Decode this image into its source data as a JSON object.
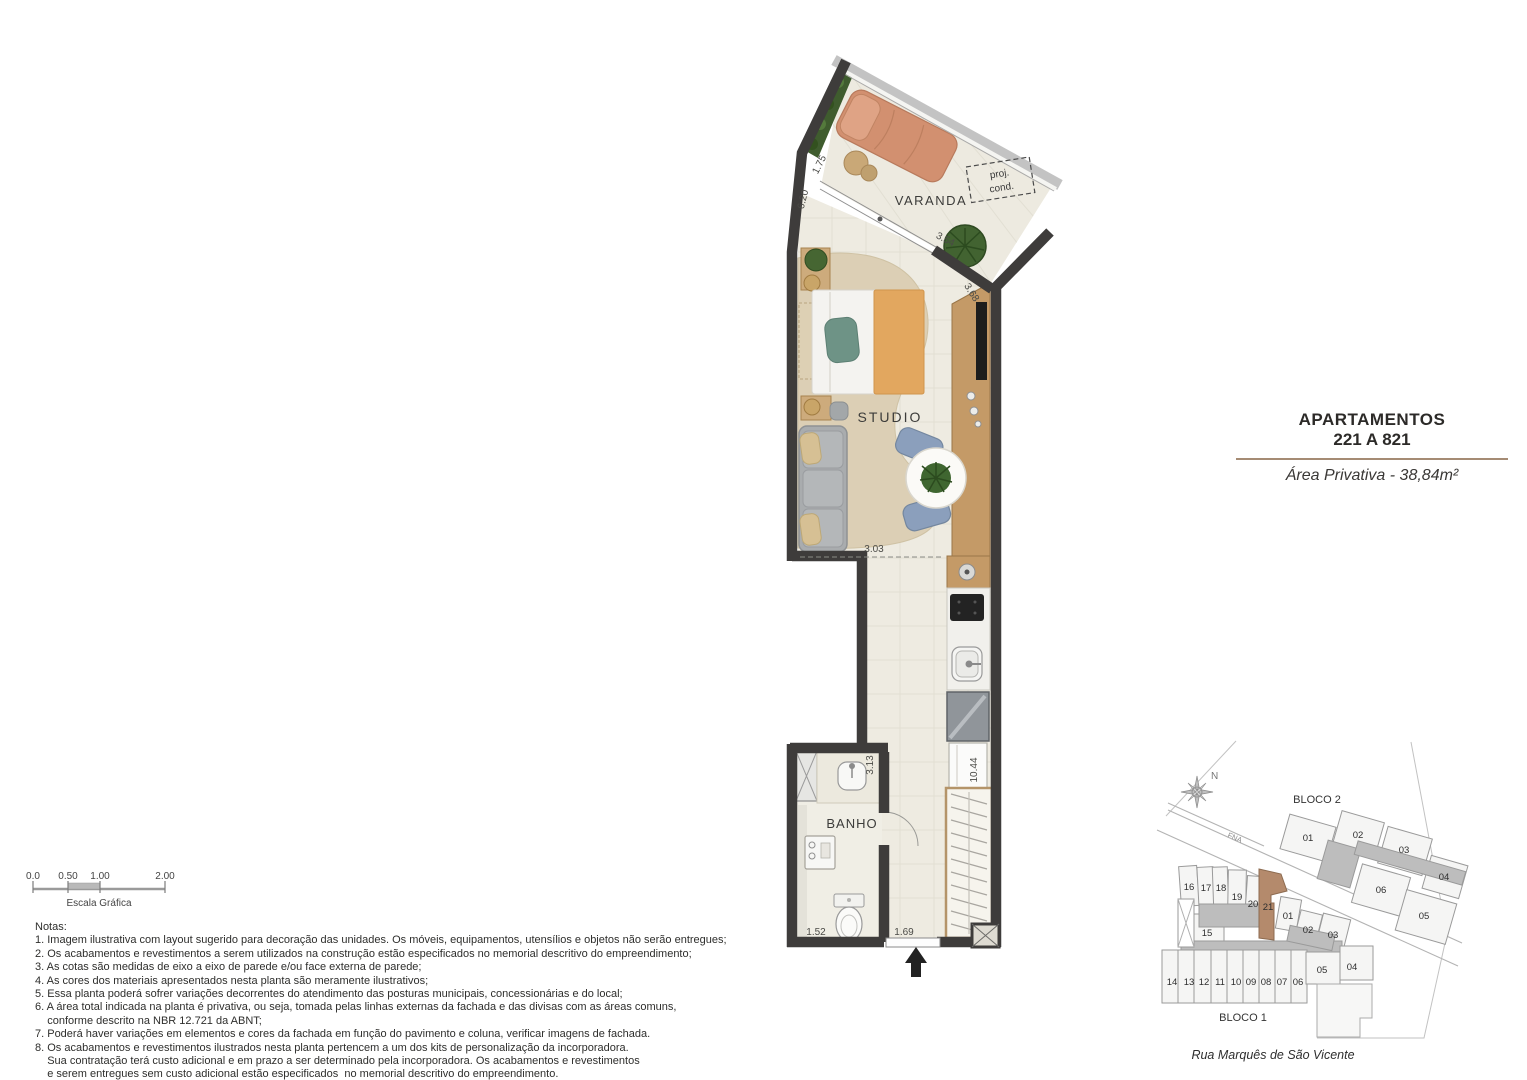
{
  "title_block": {
    "line1": "APARTAMENTOS",
    "line2": "221 A 821",
    "area_label": "Área Privativa - 38,84m²"
  },
  "floor_plan": {
    "room_labels": {
      "varanda": "VARANDA",
      "studio": "STUDIO",
      "banho": "BANHO"
    },
    "proj_cond": {
      "line1": "proj.",
      "line2": "cond."
    },
    "dimensions": {
      "varanda_width": "1.75",
      "left_side": "6.20",
      "varanda_door": "3.54",
      "angled_wall": "3.68",
      "studio_width": "3.03",
      "bath_depth": "3.13",
      "right_side": "10.44",
      "bath_width": "1.52",
      "entry_width": "1.69"
    }
  },
  "scale_bar": {
    "ticks": [
      "0.0",
      "0.50",
      "1.00",
      "2.00"
    ],
    "caption": "Escala Gráfica"
  },
  "notes": {
    "lines": [
      "Notas:",
      "1. Imagem ilustrativa com layout sugerido para decoração das unidades. Os móveis, equipamentos, utensílios e objetos não serão entregues;",
      "2. Os acabamentos e revestimentos a serem utilizados na construção estão especificados no memorial descritivo do empreendimento;",
      "3. As cotas são medidas de eixo a eixo de parede e/ou face externa de parede;",
      "4. As cores dos materiais apresentados nesta planta são meramente ilustrativos;",
      "5. Essa planta poderá sofrer variações decorrentes do atendimento das posturas municipais, concessionárias e do local;",
      "6. A área total indicada na planta é privativa, ou seja, tomada pelas linhas externas da fachada e das divisas com as áreas comuns,",
      "    conforme descrito na NBR 12.721 da ABNT;",
      "7. Poderá haver variações em elementos e cores da fachada em função do pavimento e coluna, verificar imagens de fachada.",
      "8. Os acabamentos e revestimentos ilustrados nesta planta pertencem a um dos kits de personalização da incorporadora.",
      "    Sua contratação terá custo adicional e em prazo a ser determinado pela incorporadora. Os acabamentos e revestimentos",
      "    e serem entregues sem custo adicional estão especificados  no memorial descritivo do empreendimento."
    ]
  },
  "site_plan": {
    "north_label": "N",
    "road_label": "FNA",
    "bloco2": {
      "label": "BLOCO 2",
      "units": [
        "01",
        "02",
        "03",
        "04",
        "06",
        "05"
      ]
    },
    "bloco1": {
      "label": "BLOCO 1",
      "top_units": [
        "16",
        "17",
        "18",
        "19",
        "20",
        "21",
        "01",
        "02",
        "03"
      ],
      "unit_15": "15",
      "right_units": [
        "05",
        "04"
      ],
      "bottom_units": [
        "14",
        "13",
        "12",
        "11",
        "10",
        "09",
        "08",
        "07",
        "06"
      ],
      "highlighted_unit": "21"
    },
    "street_label": "Rua Marquês de São Vicente"
  },
  "colors": {
    "wall": "#3e3c3b",
    "wood": "#c49a67",
    "floor": "#eeebe1",
    "rug": "#dccfb5",
    "highlight_unit": "#b48a6c",
    "accent_line": "#a58b74"
  }
}
